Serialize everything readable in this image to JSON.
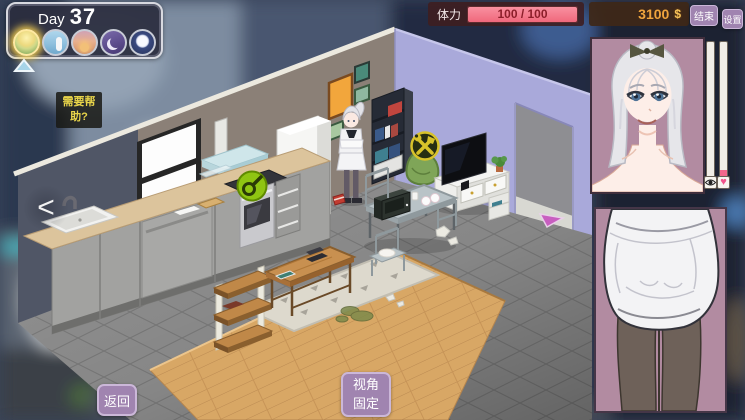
{
  "hud": {
    "day": {
      "label": "Day",
      "number": "37"
    },
    "time_slots": [
      {
        "name": "dawn",
        "selected": true
      },
      {
        "name": "morning",
        "selected": false
      },
      {
        "name": "dusk",
        "selected": false
      },
      {
        "name": "night",
        "selected": false
      },
      {
        "name": "midnight",
        "selected": false
      }
    ],
    "stamina": {
      "label": "体力",
      "value": "100 / 100",
      "percent": 100
    },
    "money": {
      "amount": "3100",
      "currency_symbol": "$"
    },
    "buttons": {
      "end": "结束",
      "settings": "设置",
      "back": "返回",
      "view_lock_line1": "视角",
      "view_lock_line2": "固定"
    },
    "help_note": "需要帮助?",
    "nav_prev": "<"
  },
  "character_panel": {
    "stats": [
      {
        "icon": "eye",
        "fill_percent": 0
      },
      {
        "icon": "heart",
        "fill_percent": 10,
        "color": "#f2688c"
      }
    ]
  },
  "scene_icons": {
    "cook_station": "pan-icon",
    "repair_spot": "crossed-tools-icon",
    "exit": "arrow-icon"
  },
  "colors": {
    "button_purple": "#a084b0",
    "stamina_fill": "#f5838f",
    "money_text": "#efa43d",
    "portrait_bg": "#b28ba1"
  }
}
